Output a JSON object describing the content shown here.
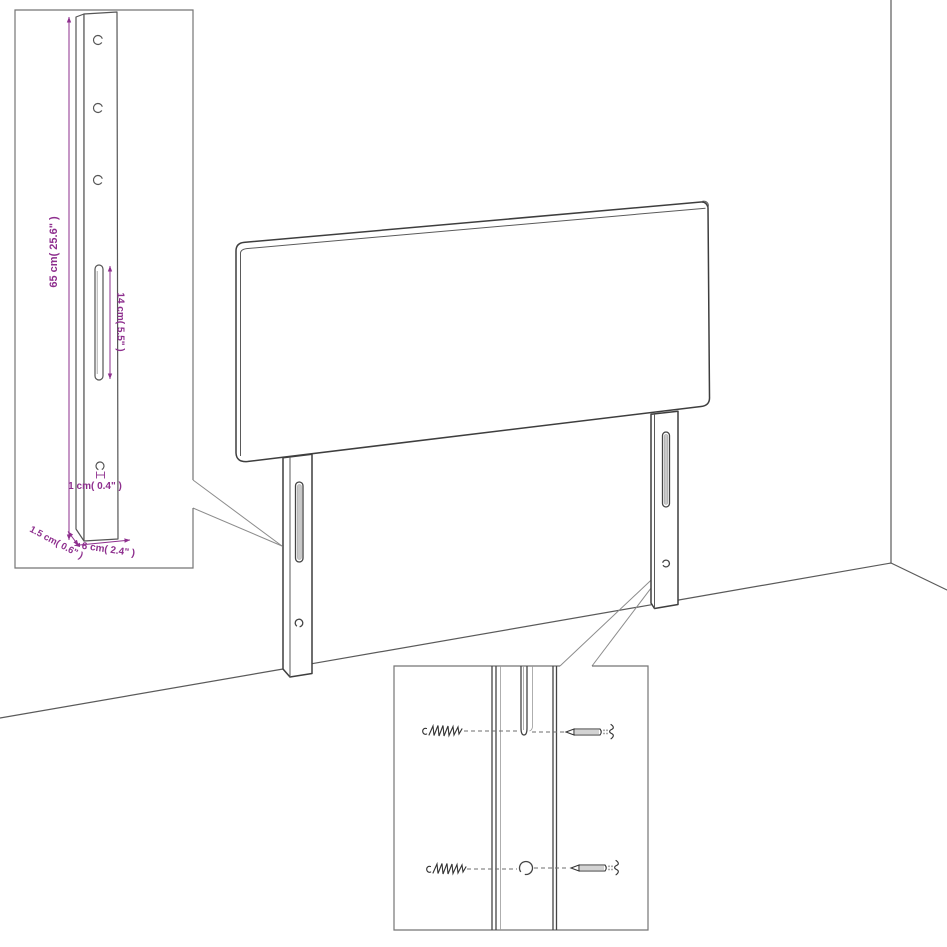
{
  "colors": {
    "dimension_color": "#8e2f8e",
    "outline_color": "#3e3e3e",
    "background": "#ffffff"
  },
  "post_inset": {
    "height_label": "65 cm( 25.6\" )",
    "slot_label": "14 cm( 5.5\" )",
    "hole_label": "1 cm( 0.4\" )",
    "depth_label": "1.5 cm( 0.6\" )",
    "width_label": "6 cm( 2.4\" )"
  }
}
